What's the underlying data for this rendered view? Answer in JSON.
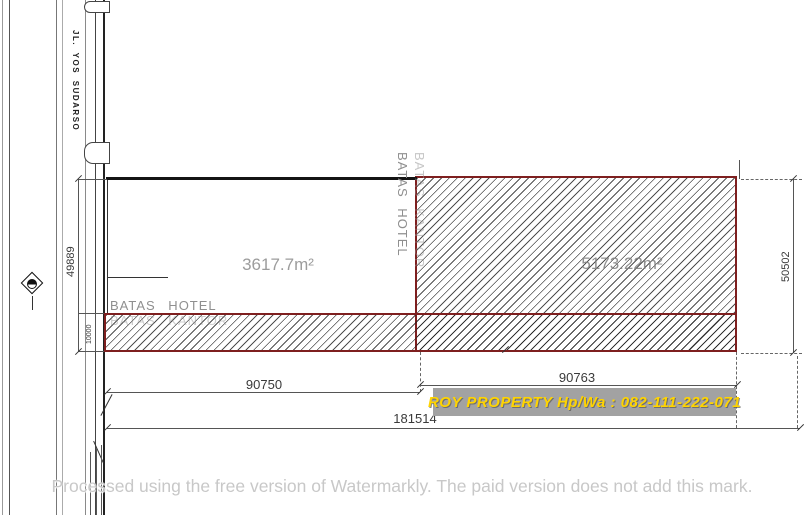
{
  "title": "Land plot site plan",
  "road": {
    "label": "JL. YOS SUDARSO"
  },
  "plots": {
    "left_area": "3617.7m²",
    "right_area": "5173.22m²"
  },
  "boundaries": {
    "batas_hotel_h": "BATAS HOTEL",
    "batas_kantor_h": "BATAS KANTOR",
    "batas_hotel_v": "BATAS HOTEL",
    "batas_kantor_v": "BATAS KANTOR"
  },
  "dimensions": {
    "left_height": "49889",
    "strip_height": "10000",
    "right_height": "50502",
    "bottom_left_width": "90750",
    "bottom_right_width": "90763",
    "total_width": "181514"
  },
  "watermarks": {
    "ad": "ROY PROPERTY Hp/Wa : 082-111-222-071",
    "watermarkly": "Processed using the free version of Watermarkly. The paid version does not add this mark."
  },
  "colors": {
    "plot_border": "#7e1f1f",
    "ad_bg": "#a2a2a2",
    "ad_text": "#ffd400",
    "dim_line": "#555555"
  }
}
